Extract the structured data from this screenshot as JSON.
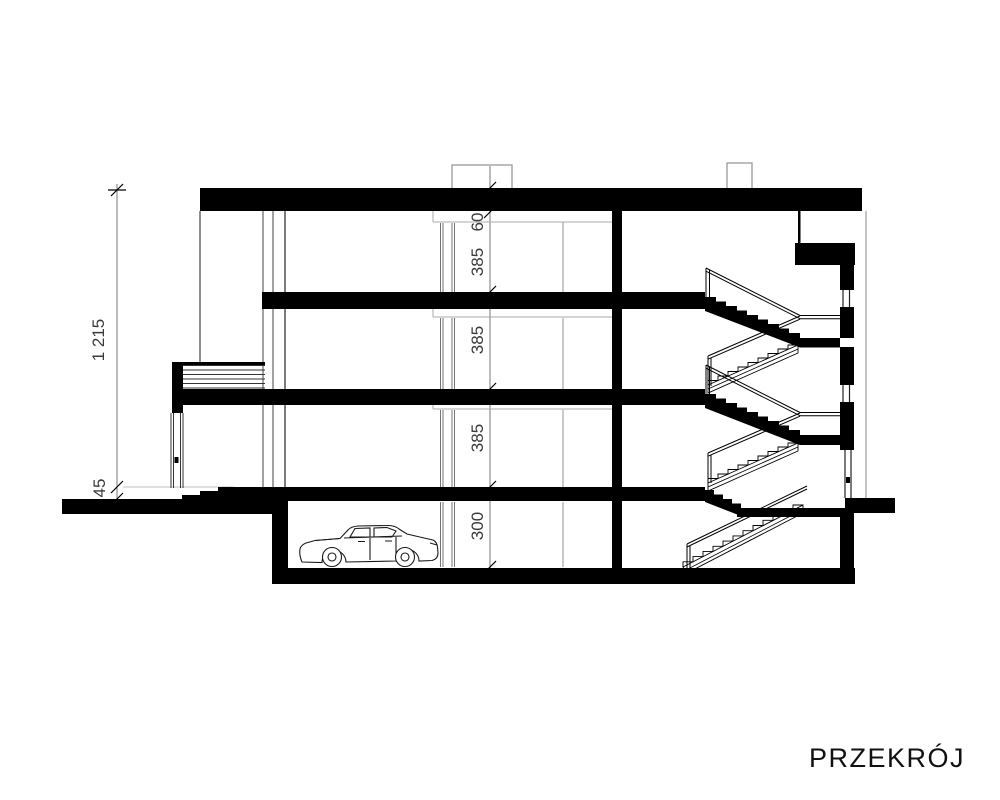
{
  "drawing": {
    "title": "PRZEKRÓJ",
    "dims": {
      "left_total": "1 215",
      "left_step": "45",
      "chain": [
        "60",
        "385",
        "385",
        "385",
        "300"
      ]
    },
    "colors": {
      "ink": "#000000",
      "dim_line": "#777777",
      "thin_line": "#999999"
    }
  }
}
